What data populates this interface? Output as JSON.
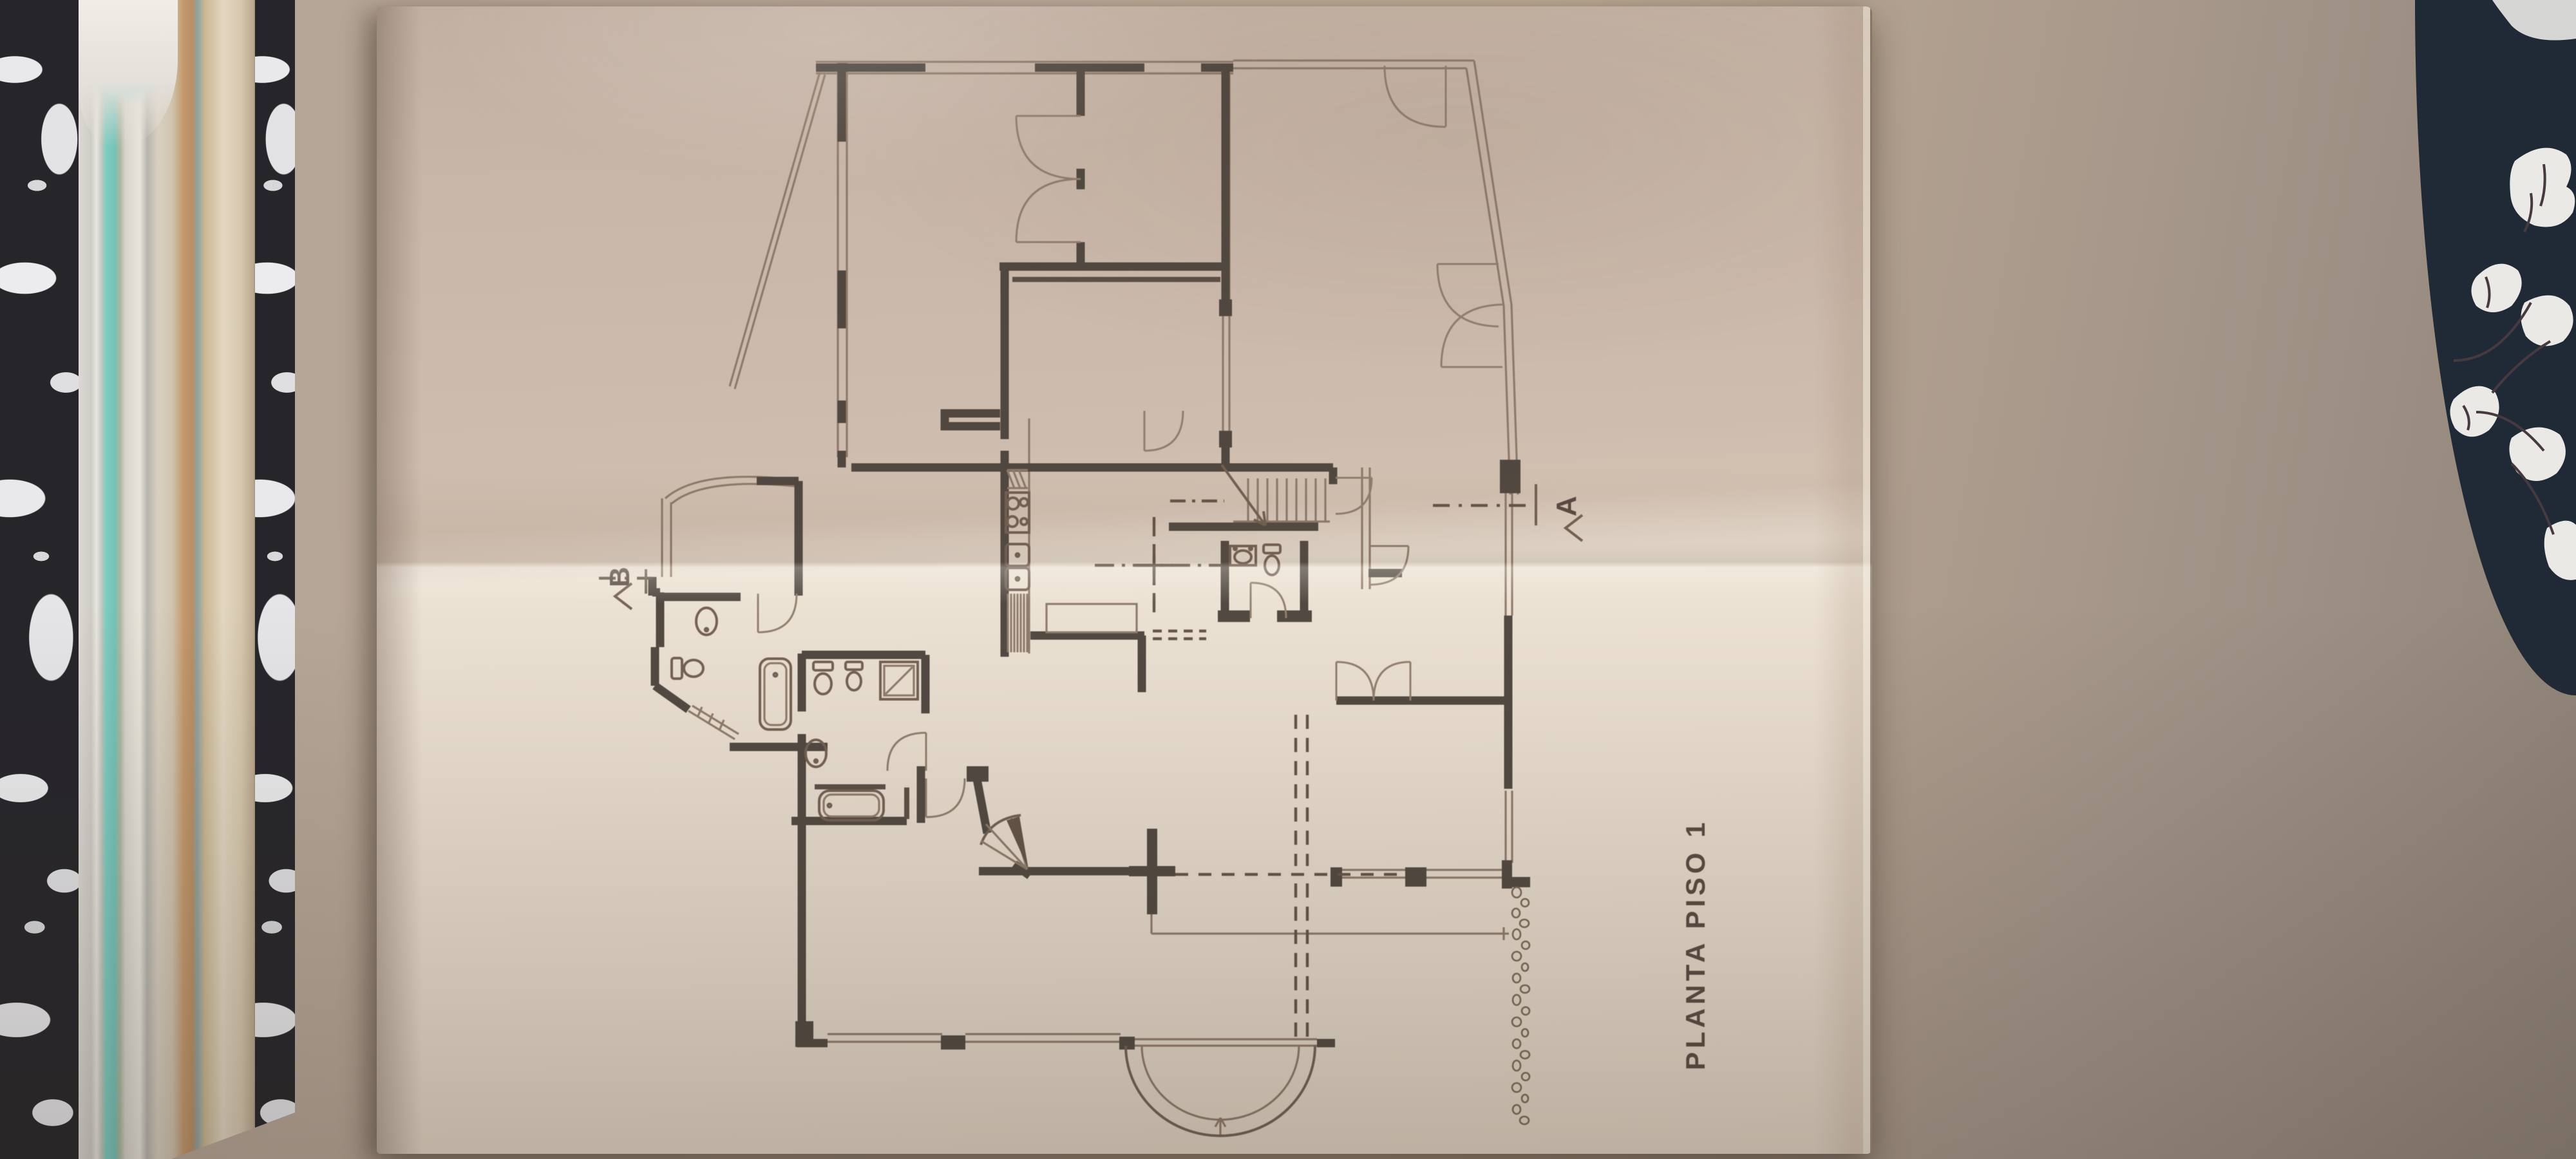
{
  "scene": {
    "plan_title": "PLANTA PISO 1",
    "section_a_label": "A",
    "section_b_label": "B",
    "colors": {
      "wall": "#b5a494",
      "wall_shadow": "#8e8276",
      "paper_lit": "#ebe0d2",
      "paper_shade": "#c9b7a9",
      "ink_walls": "#49413a",
      "ink_thin": "#8a7666",
      "book_cover": "#26252a",
      "book_marble": "#e9e9eb",
      "page_teal": "#7fccc1",
      "fabric_navy": "#202a36",
      "fabric_floral": "#eae9e5"
    }
  }
}
